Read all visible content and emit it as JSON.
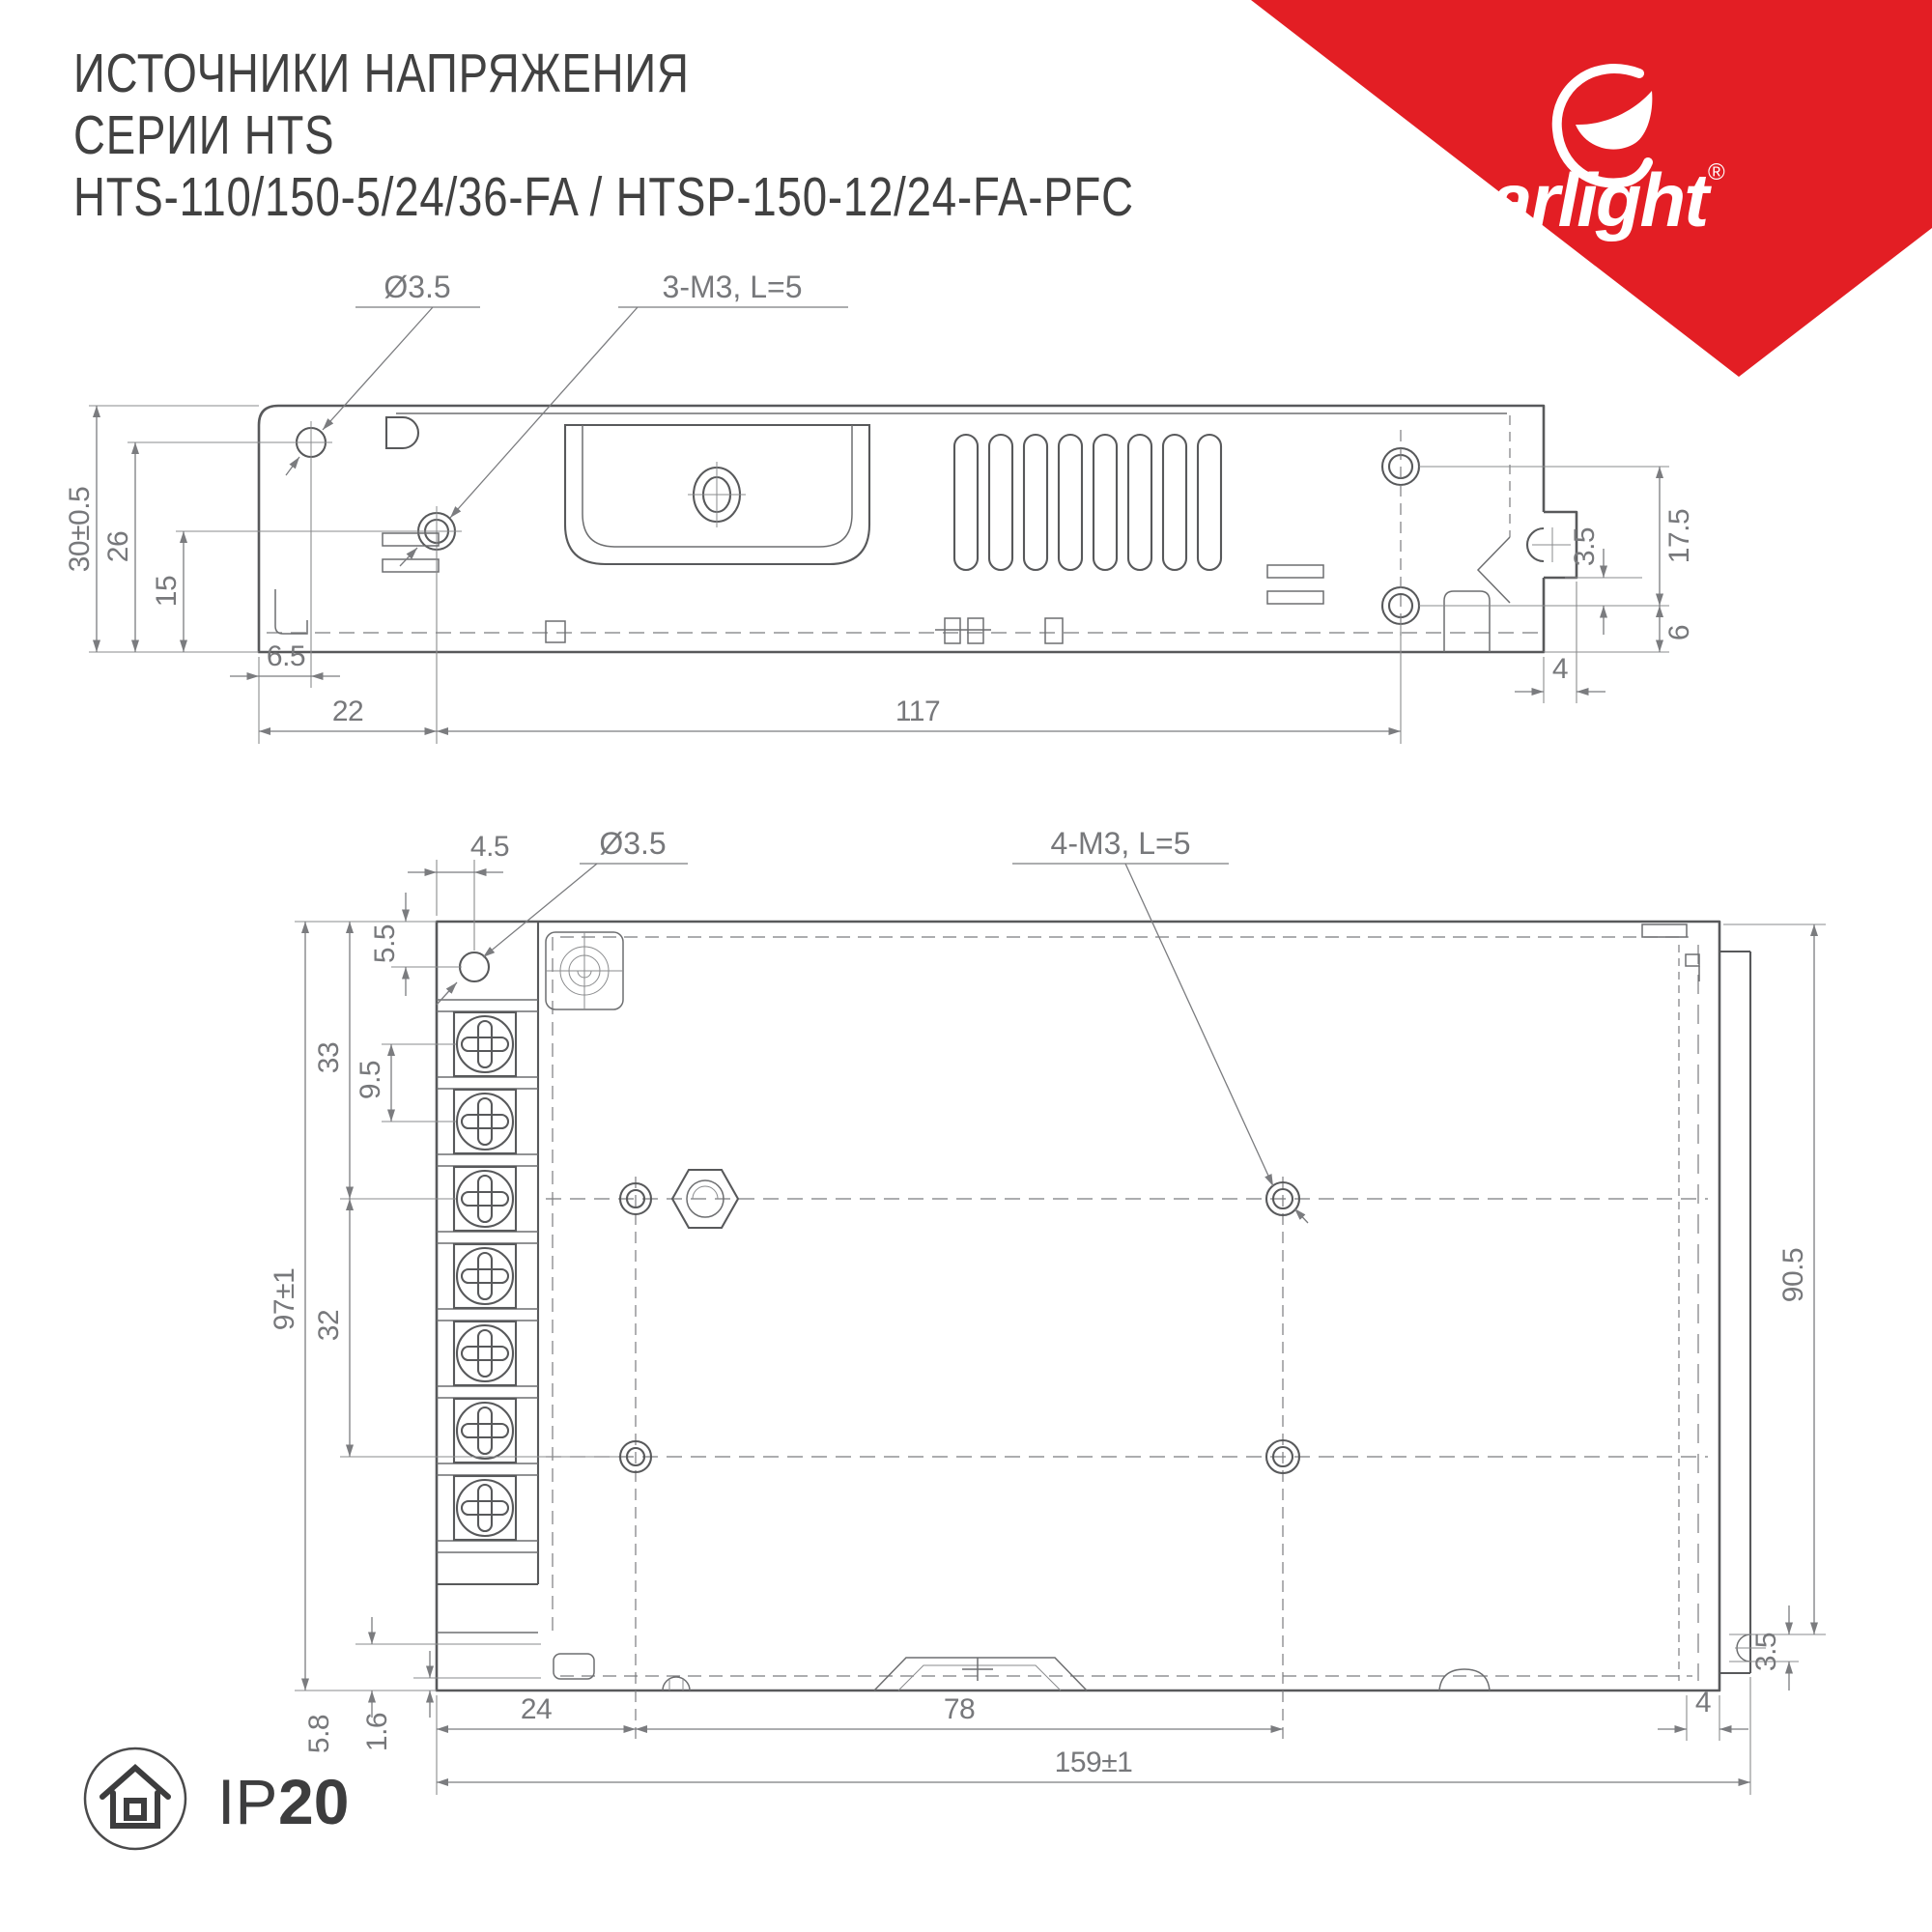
{
  "header": {
    "title_line1": "ИСТОЧНИКИ НАПРЯЖЕНИЯ",
    "title_line2": "СЕРИИ HTS",
    "title_line3": "HTS-110/150-5/24/36-FA / HTSP-150-12/24-FA-PFC"
  },
  "logo": {
    "brand": "arlight",
    "registered": "®",
    "color": "#e31e24"
  },
  "top_drawing": {
    "view": "side view",
    "labels": {
      "hole_callout": "Ø3.5",
      "screw_callout": "3-M3, L=5"
    },
    "dims": {
      "h_outer": "30±0.5",
      "h_hole": "26",
      "h_screw": "15",
      "left_offset": "6.5",
      "screw_from_left": "22",
      "hole_span": "117",
      "tab_width": "4",
      "hole_pitch": "17.5",
      "notch_offset": "3.5",
      "base_offset": "6"
    }
  },
  "bottom_drawing": {
    "view": "bottom view",
    "labels": {
      "hole_offset": "4.5",
      "hole_callout": "Ø3.5",
      "screw_callout": "4-M3, L=5"
    },
    "dims": {
      "hole_down": "5.5",
      "term_first": "33",
      "term_pitch": "9.5",
      "h_outer": "97±1",
      "row_span": "32",
      "cover_height": "90.5",
      "foot": "5.8",
      "plate": "1.6",
      "hole_from_left": "24",
      "hole_span_x": "78",
      "w_outer": "159±1",
      "lip": "4",
      "notch": "3.5"
    }
  },
  "footer": {
    "ip_label": "IP",
    "ip_value": "20"
  }
}
